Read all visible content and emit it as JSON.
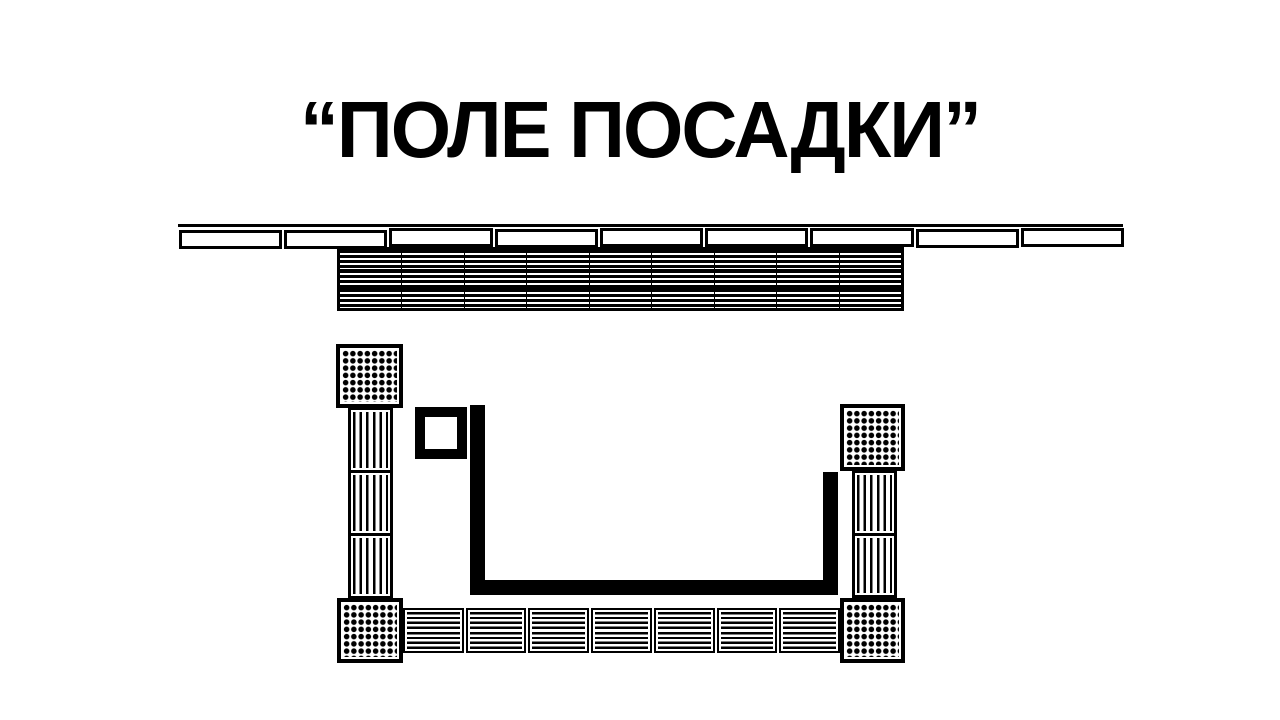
{
  "title": "“ПОЛЕ ПОСАДКИ”",
  "colors": {
    "ink": "#000000",
    "paper": "#ffffff"
  },
  "plan": {
    "crate_row": {
      "count": 9
    },
    "pallet_grid": {
      "rows": 3,
      "cols": 9
    },
    "left_column": {
      "segments": 3
    },
    "right_column": {
      "segments": 2
    },
    "bottom_row": {
      "segments": 7
    },
    "dot_blocks": {
      "count": 4,
      "dot_rows": 8,
      "dot_cols": 8
    }
  }
}
